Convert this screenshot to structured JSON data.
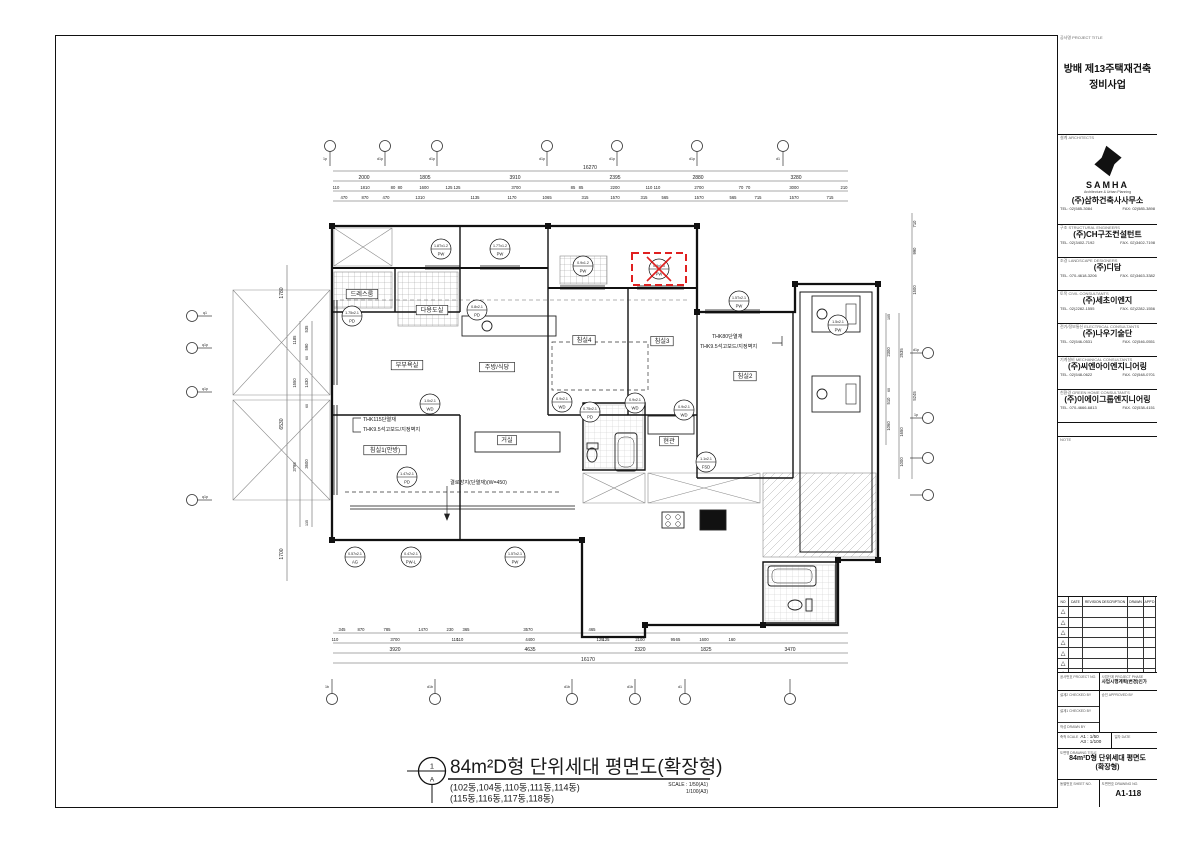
{
  "accent_red": "#e02020",
  "title_block": {
    "project": {
      "header": "공사명 PROJECT TITLE",
      "name1": "방배 제13주택재건축",
      "name2": "정비사업"
    },
    "architect": {
      "header": "설계 ARCHITECTS",
      "logo_word": "SAMHA",
      "logo_sub": "Architecture & Urban Planning",
      "name": "(주)삼하건축사사무소",
      "tel": "TEL: 02)585-3084",
      "fax": "FAX: 02)585-3898"
    },
    "consultants": [
      {
        "header": "구조 STRUCTURAL ENGINEERS",
        "name": "(주)CH구조컨설턴트",
        "tel": "TEL. 02)3402-7192",
        "fax": "FAX. 02)3402-7198"
      },
      {
        "header": "조경 LANDSCAPE DESIGNERS",
        "name": "(주)디담",
        "tel": "TEL. 070-4618-3206",
        "fax": "FAX. 02)3463-3382"
      },
      {
        "header": "토목 CIVIL CONSULTANTS",
        "name": "(주)세초이엔지",
        "tel": "TEL. 02)2282-1555",
        "fax": "FAX. 02)2282-1556"
      },
      {
        "header": "전기/정보통신 ELECTRICAL CONSULTANTS",
        "name": "(주)나우기술단",
        "tel": "TEL. 02)546-0531",
        "fax": "FAX. 02)546-0551"
      },
      {
        "header": "기계설비 MECHANICAL CONSULTANTS",
        "name": "(주)씨엔아이엔지니어링",
        "tel": "TEL. 02)548-0622",
        "fax": "FAX. 02)548-0701"
      },
      {
        "header": "친환경 GREEN HOME CONSULTANTS",
        "name": "(주)이에이그룹엔지니어링",
        "tel": "TEL. 070-4666-6813",
        "fax": "FAX. 02)538-4151"
      }
    ],
    "note_header": "NOTE",
    "revision": {
      "headers": [
        "NO",
        "DATE",
        "REVISION DESCRIPTION",
        "DRAWN",
        "APP'D"
      ],
      "row_count": 7,
      "marker": "△"
    },
    "meta": {
      "project_no_header": "공사번호 PROJECT NO.",
      "phase_header": "사업단계 PROJECT PHASE",
      "phase_value": "사업시행계획(변경)인가",
      "checked2_header": "설계2 CHECKED BY",
      "checked1_header": "설계1 CHECKED BY",
      "drawn_header": "작성 DRAWN BY",
      "approved_header": "승인 APPROVED BY",
      "scale_header": "축척 SCALE",
      "scale_a1": "A1 : 1/50",
      "scale_a3": "A3 : 1/100",
      "date_header": "일자 DATE",
      "title_header": "도면명 DRAWING TITLE",
      "title_value1": "84m²D형 단위세대 평면도",
      "title_value2": "(확장형)",
      "bldg_no_header": "동별번호 SHEET NO.",
      "drawing_no_header": "도면번호 DRAWING NO.",
      "drawing_no": "A1-118"
    }
  },
  "drawing": {
    "title": "84m²D형 단위세대 평면도(확장형)",
    "sub1": "(102동,104동,110동,111동,114동)",
    "sub2": "(115동,116동,117동,118동)",
    "scale1": "SCALE : 1/50(A1)",
    "scale2": "1/100(A3)",
    "marker_top": "1",
    "marker_bottom": "A"
  },
  "plan": {
    "rooms": [
      [
        "드레스룸",
        362,
        294
      ],
      [
        "다용도실",
        432,
        310
      ],
      [
        "부부욕실",
        407,
        365
      ],
      [
        "주방/식당",
        497,
        367
      ],
      [
        "거실",
        507,
        440
      ],
      [
        "침실1(안방)",
        385,
        450
      ],
      [
        "침실4",
        584,
        340
      ],
      [
        "침실3",
        662,
        341
      ],
      [
        "침실2",
        745,
        376
      ],
      [
        "현관",
        669,
        441
      ]
    ],
    "tags": [
      [
        "1.8Tx1.2",
        "PW",
        441,
        249,
        0
      ],
      [
        "1.7Tx1.2",
        "PW",
        500,
        249,
        0
      ],
      [
        "0.9x1.2",
        "PW",
        583,
        266,
        0
      ],
      [
        "0.9x1.5",
        "PW",
        659,
        269,
        1
      ],
      [
        "1.5Tx2.1",
        "PW",
        739,
        301,
        0
      ],
      [
        "1.75x2.1",
        "PD",
        352,
        316,
        0
      ],
      [
        "0.8x2.1",
        "PD",
        477,
        310,
        0
      ],
      [
        "1.0x2.1",
        "WD",
        430,
        404,
        0
      ],
      [
        "0.9x2.1",
        "WD",
        562,
        402,
        0
      ],
      [
        "0.75x2.1",
        "PD",
        590,
        412,
        0
      ],
      [
        "0.9x2.1",
        "WD",
        635,
        403,
        0
      ],
      [
        "0.9x2.1",
        "WD",
        684,
        410,
        0
      ],
      [
        "1.1x2.1",
        "FSD",
        706,
        462,
        0
      ],
      [
        "1.5x2.1",
        "PW",
        838,
        325,
        0
      ],
      [
        "1.47x2.1",
        "PD",
        407,
        477,
        0
      ],
      [
        "0.57x2.1",
        "AG",
        355,
        557,
        0
      ],
      [
        "0.47x2.1",
        "PW-L",
        411,
        557,
        0
      ],
      [
        "1.5Tx2.1",
        "PW",
        515,
        557,
        0
      ]
    ],
    "notes": [
      [
        "THK115단열재",
        363,
        421
      ],
      [
        "THK9.5석고보드/지정벽지",
        363,
        431
      ],
      [
        "THK80단열재",
        712,
        338
      ],
      [
        "THK9.5석고보드/지정벽지",
        700,
        348
      ],
      [
        "결로방지(단열재)(W=450)",
        450,
        484
      ]
    ],
    "dims": [
      [
        "16270",
        590,
        169,
        5,
        0
      ],
      [
        "2000",
        364,
        179,
        5,
        0
      ],
      [
        "1805",
        425,
        179,
        5,
        0
      ],
      [
        "3910",
        515,
        179,
        5,
        0
      ],
      [
        "2395",
        615,
        179,
        5,
        0
      ],
      [
        "2880",
        698,
        179,
        5,
        0
      ],
      [
        "3280",
        796,
        179,
        5,
        0
      ],
      [
        "110",
        336,
        189,
        4.2,
        0
      ],
      [
        "1810",
        365,
        189,
        4.2,
        0
      ],
      [
        "80",
        393,
        189,
        4.2,
        0
      ],
      [
        "80",
        400,
        189,
        4.2,
        0
      ],
      [
        "1600",
        424,
        189,
        4.2,
        0
      ],
      [
        "125",
        449,
        189,
        4.2,
        0
      ],
      [
        "125",
        457,
        189,
        4.2,
        0
      ],
      [
        "3700",
        516,
        189,
        4.2,
        0
      ],
      [
        "85",
        573,
        189,
        4.2,
        0
      ],
      [
        "85",
        581,
        189,
        4.2,
        0
      ],
      [
        "2200",
        615,
        189,
        4.2,
        0
      ],
      [
        "110",
        649,
        189,
        4.2,
        0
      ],
      [
        "110",
        657,
        189,
        4.2,
        0
      ],
      [
        "2700",
        699,
        189,
        4.2,
        0
      ],
      [
        "70",
        741,
        189,
        4.2,
        0
      ],
      [
        "70",
        748,
        189,
        4.2,
        0
      ],
      [
        "3000",
        794,
        189,
        4.2,
        0
      ],
      [
        "210",
        844,
        189,
        4.2,
        0
      ],
      [
        "470",
        344,
        199,
        4.2,
        0
      ],
      [
        "870",
        365,
        199,
        4.2,
        0
      ],
      [
        "470",
        386,
        199,
        4.2,
        0
      ],
      [
        "1310",
        420,
        199,
        4.2,
        0
      ],
      [
        "1135",
        475,
        199,
        4.2,
        0
      ],
      [
        "1170",
        512,
        199,
        4.2,
        0
      ],
      [
        "1065",
        547,
        199,
        4.2,
        0
      ],
      [
        "315",
        585,
        199,
        4.2,
        0
      ],
      [
        "1570",
        615,
        199,
        4.2,
        0
      ],
      [
        "315",
        644,
        199,
        4.2,
        0
      ],
      [
        "565",
        665,
        199,
        4.2,
        0
      ],
      [
        "1570",
        699,
        199,
        4.2,
        0
      ],
      [
        "565",
        733,
        199,
        4.2,
        0
      ],
      [
        "715",
        758,
        199,
        4.2,
        0
      ],
      [
        "1570",
        794,
        199,
        4.2,
        0
      ],
      [
        "715",
        830,
        199,
        4.2,
        0
      ],
      [
        "345",
        342,
        631,
        4.2,
        0
      ],
      [
        "870",
        361,
        631,
        4.2,
        0
      ],
      [
        "785",
        387,
        631,
        4.2,
        0
      ],
      [
        "1470",
        423,
        631,
        4.2,
        0
      ],
      [
        "230",
        450,
        631,
        4.2,
        0
      ],
      [
        "365",
        466,
        631,
        4.2,
        0
      ],
      [
        "3570",
        528,
        631,
        4.2,
        0
      ],
      [
        "465",
        592,
        631,
        4.2,
        0
      ],
      [
        "110",
        335,
        641,
        4.2,
        0
      ],
      [
        "3700",
        395,
        641,
        4.2,
        0
      ],
      [
        "110",
        455,
        641,
        4.2,
        0
      ],
      [
        "110",
        460,
        641,
        4.2,
        0
      ],
      [
        "4400",
        530,
        641,
        4.2,
        0
      ],
      [
        "125",
        600,
        641,
        4.2,
        0
      ],
      [
        "125",
        606,
        641,
        4.2,
        0
      ],
      [
        "2100",
        640,
        641,
        4.2,
        0
      ],
      [
        "95",
        673,
        641,
        4.2,
        0
      ],
      [
        "65",
        678,
        641,
        4.2,
        0
      ],
      [
        "1600",
        704,
        641,
        4.2,
        0
      ],
      [
        "160",
        732,
        641,
        4.2,
        0
      ],
      [
        "3920",
        395,
        651,
        5,
        0
      ],
      [
        "4635",
        530,
        651,
        5,
        0
      ],
      [
        "2320",
        640,
        651,
        5,
        0
      ],
      [
        "1825",
        706,
        651,
        5,
        0
      ],
      [
        "3470",
        790,
        651,
        5,
        0
      ],
      [
        "16170",
        588,
        661,
        5,
        0
      ],
      [
        "1780",
        283,
        293,
        5,
        1
      ],
      [
        "6530",
        283,
        424,
        5,
        1
      ],
      [
        "1700",
        283,
        554,
        5,
        1
      ],
      [
        "1185",
        296,
        340,
        4.2,
        1
      ],
      [
        "1550",
        296,
        383,
        4.2,
        1
      ],
      [
        "3795",
        296,
        467,
        4.2,
        1
      ],
      [
        "535",
        308,
        329,
        4.2,
        1
      ],
      [
        "590",
        308,
        347,
        4.2,
        1
      ],
      [
        "60",
        308,
        358,
        3.6,
        1
      ],
      [
        "1430",
        308,
        383,
        4.2,
        1
      ],
      [
        "60",
        308,
        406,
        3.6,
        1
      ],
      [
        "3600",
        308,
        464,
        4.2,
        1
      ],
      [
        "135",
        308,
        523,
        3.6,
        1
      ],
      [
        "710",
        916,
        224,
        4.2,
        1
      ],
      [
        "990",
        916,
        251,
        4.2,
        1
      ],
      [
        "1500",
        916,
        290,
        4.2,
        1
      ],
      [
        "5245",
        916,
        396,
        4.2,
        1
      ],
      [
        "2535",
        903,
        353,
        4.2,
        1
      ],
      [
        "1650",
        903,
        432,
        4.2,
        1
      ],
      [
        "1000",
        903,
        462,
        4.2,
        1
      ],
      [
        "105",
        890,
        317,
        3.6,
        1
      ],
      [
        "2300",
        890,
        352,
        4.2,
        1
      ],
      [
        "60",
        890,
        390,
        3.6,
        1
      ],
      [
        "510",
        890,
        401,
        4.2,
        1
      ],
      [
        "1060",
        890,
        426,
        4.2,
        1
      ]
    ],
    "bubbles": {
      "top": [
        [
          330,
          "1p"
        ],
        [
          385,
          "d1p"
        ],
        [
          437,
          "d1p"
        ],
        [
          547,
          "d1p"
        ],
        [
          617,
          "d1p"
        ],
        [
          697,
          "d1p"
        ],
        [
          783,
          "d1"
        ]
      ],
      "bottom": [
        [
          332,
          "1b"
        ],
        [
          435,
          "d1b"
        ],
        [
          572,
          "d1b"
        ],
        [
          635,
          "d1b"
        ],
        [
          685,
          "d1"
        ],
        [
          790,
          ""
        ]
      ],
      "left": [
        [
          316,
          "q1"
        ],
        [
          348,
          "q1p"
        ],
        [
          392,
          "q1p"
        ],
        [
          500,
          "q1p"
        ]
      ],
      "right": [
        [
          353,
          "d1p"
        ],
        [
          418,
          "1p"
        ],
        [
          458,
          ""
        ],
        [
          495,
          ""
        ]
      ]
    }
  }
}
